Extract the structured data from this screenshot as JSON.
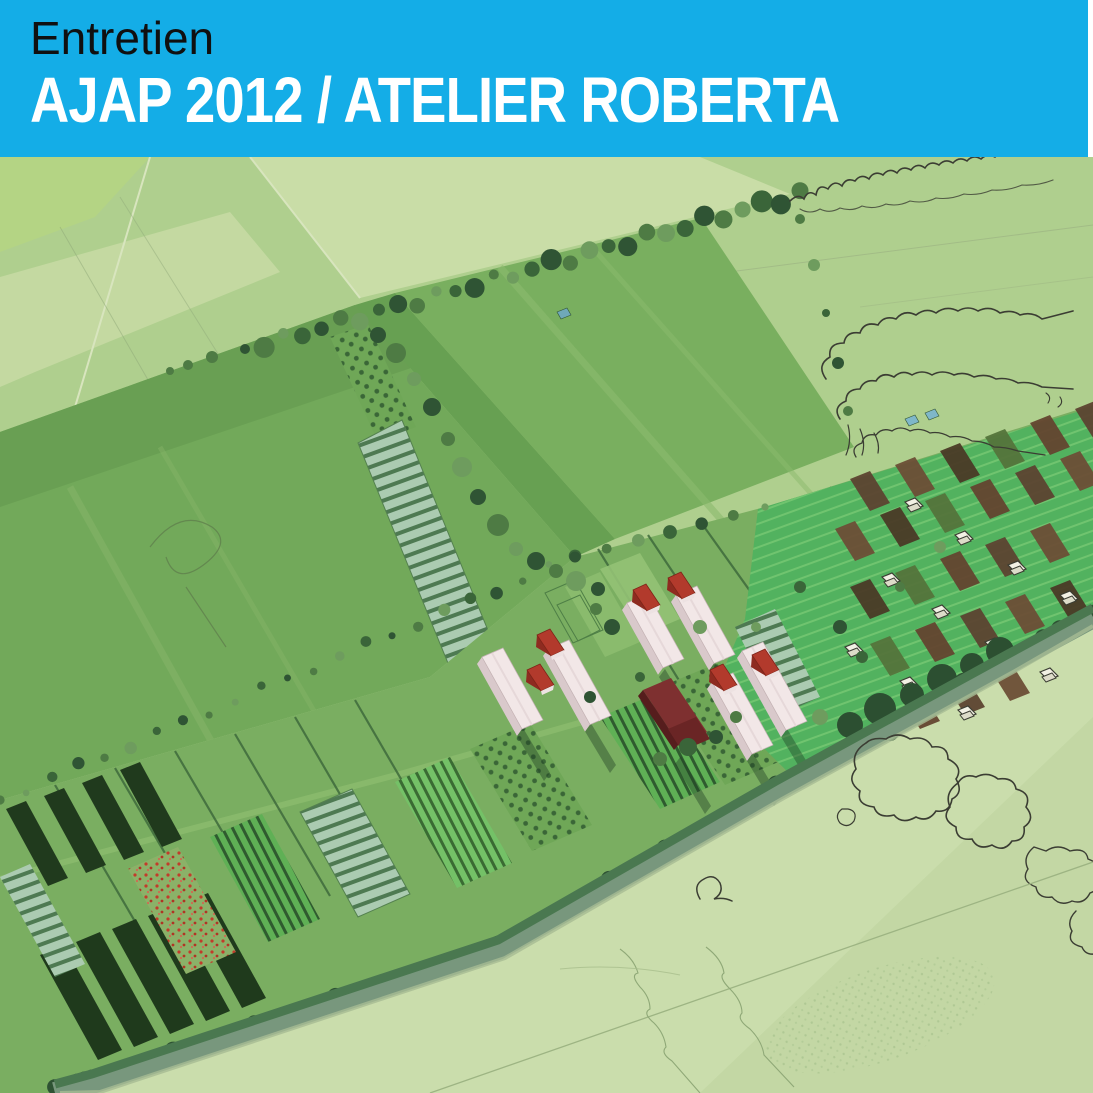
{
  "banner": {
    "kicker": "Entretien",
    "title": "AJAP 2012 / ATELIER ROBERTA"
  },
  "colors": {
    "banner-blue": "#14ADE7",
    "kicker-text": "#101010",
    "title-text": "#FFFFFF",
    "field-light": "#AFCF8E",
    "field-pale": "#C8DCA6",
    "field-medium": "#74AA5B",
    "field-bright": "#52B25F",
    "crop-rows-dark": "#203A1D",
    "escarpment-green": "#4A7850",
    "sketch-pale-green": "#CADDAC",
    "roof-red": "#B23A2C",
    "barn-maroon": "#7E3030",
    "building-white": "#F2E7E7",
    "allotment-brown": "#5C4330",
    "pen-ink": "#3B3D33"
  }
}
